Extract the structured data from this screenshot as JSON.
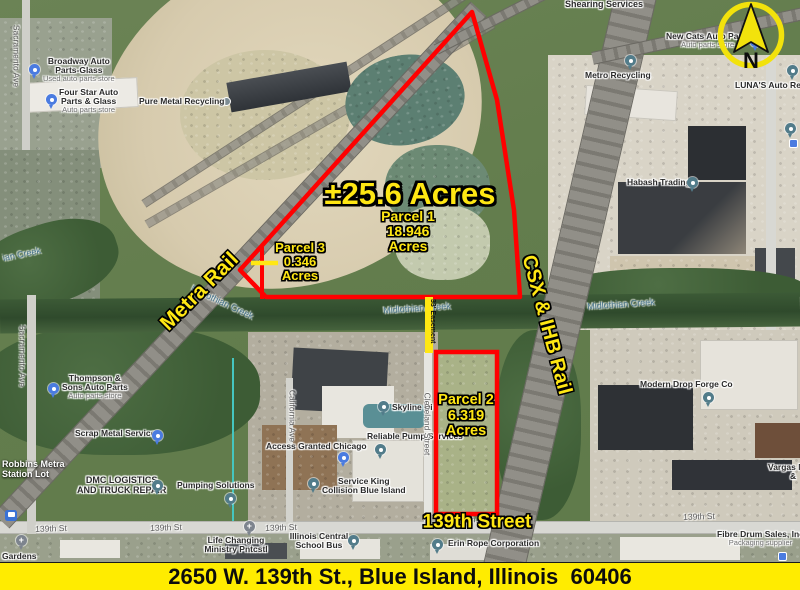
{
  "banner": {
    "address": "2650 W. 139th St., Blue Island, Illinois  60406"
  },
  "compass": {
    "letter": "N"
  },
  "colors": {
    "parcel_outline": "#ff0000",
    "annotation_yellow": "#ffe713",
    "banner_bg": "#ffec00"
  },
  "annotations": {
    "total_acres": "±25.6 Acres",
    "parcel1": {
      "line1": "Parcel 1",
      "line2": "18.946",
      "line3": "Acres"
    },
    "parcel2": {
      "line1": "Parcel 2",
      "line2": "6.319",
      "line3": "Acres"
    },
    "parcel3": {
      "line1": "Parcel 3",
      "line2": "0.346",
      "line3": "Acres"
    },
    "metra_rail": "Metra Rail",
    "csx_rail": "CSX & IHB Rail",
    "street_139": "139th Street",
    "easement": "33' Easement"
  },
  "poi": [
    {
      "line1": "Broadway Auto",
      "line2": "Parts-Glass",
      "sub": "Used auto parts store"
    },
    {
      "line1": "Four Star Auto",
      "line2": "Parts & Glass",
      "sub": "Auto parts store"
    },
    {
      "line1": "Pure Metal Recycling"
    },
    {
      "line1": "Metro Recycling"
    },
    {
      "line1": "New Cats Auto Parts",
      "sub": "Auto parts store"
    },
    {
      "line1": "LUNA'S Auto Repair"
    },
    {
      "line1": "Habash Trading"
    },
    {
      "line1": "Thompson &",
      "line2": "Sons Auto Parts",
      "sub": "Auto parts store"
    },
    {
      "line1": "Scrap Metal Services"
    },
    {
      "line1": "DMC LOGISTICS",
      "line2": "AND TRUCK REPAIR"
    },
    {
      "line1": "Pumping Solutions"
    },
    {
      "line1": "Access Granted Chicago"
    },
    {
      "line1": "Service King",
      "line2": "Collision Blue Island"
    },
    {
      "line1": "Skyline Di"
    },
    {
      "line1": "Reliable Pump Services"
    },
    {
      "line1": "Modern Drop Forge Co"
    },
    {
      "line1": "Erin Rope Corporation"
    },
    {
      "line1": "Fibre Drum Sales, Inc",
      "sub": "Packaging supplier"
    },
    {
      "line1": "Life Changing",
      "line2": "Ministry Pntcstl"
    },
    {
      "line1": "Illinois Central",
      "line2": "School Bus"
    },
    {
      "line1": "Vargas M",
      "line2": "&"
    },
    {
      "line1": "Gardens"
    },
    {
      "line1": "Robbins Metra",
      "line2": "Station Lot"
    },
    {
      "line1": "Shearing Services"
    }
  ],
  "street_labels": [
    "Sacramento Ave",
    "Sacramento Ave",
    "California Ave",
    "Cleveland Street",
    "139th St",
    "139th St",
    "139th St",
    "139th St",
    "139th St"
  ],
  "creek_labels": [
    "ian Creek",
    "Midlothian Creek",
    "Midlothian Creek",
    "Midlothian Creek"
  ]
}
